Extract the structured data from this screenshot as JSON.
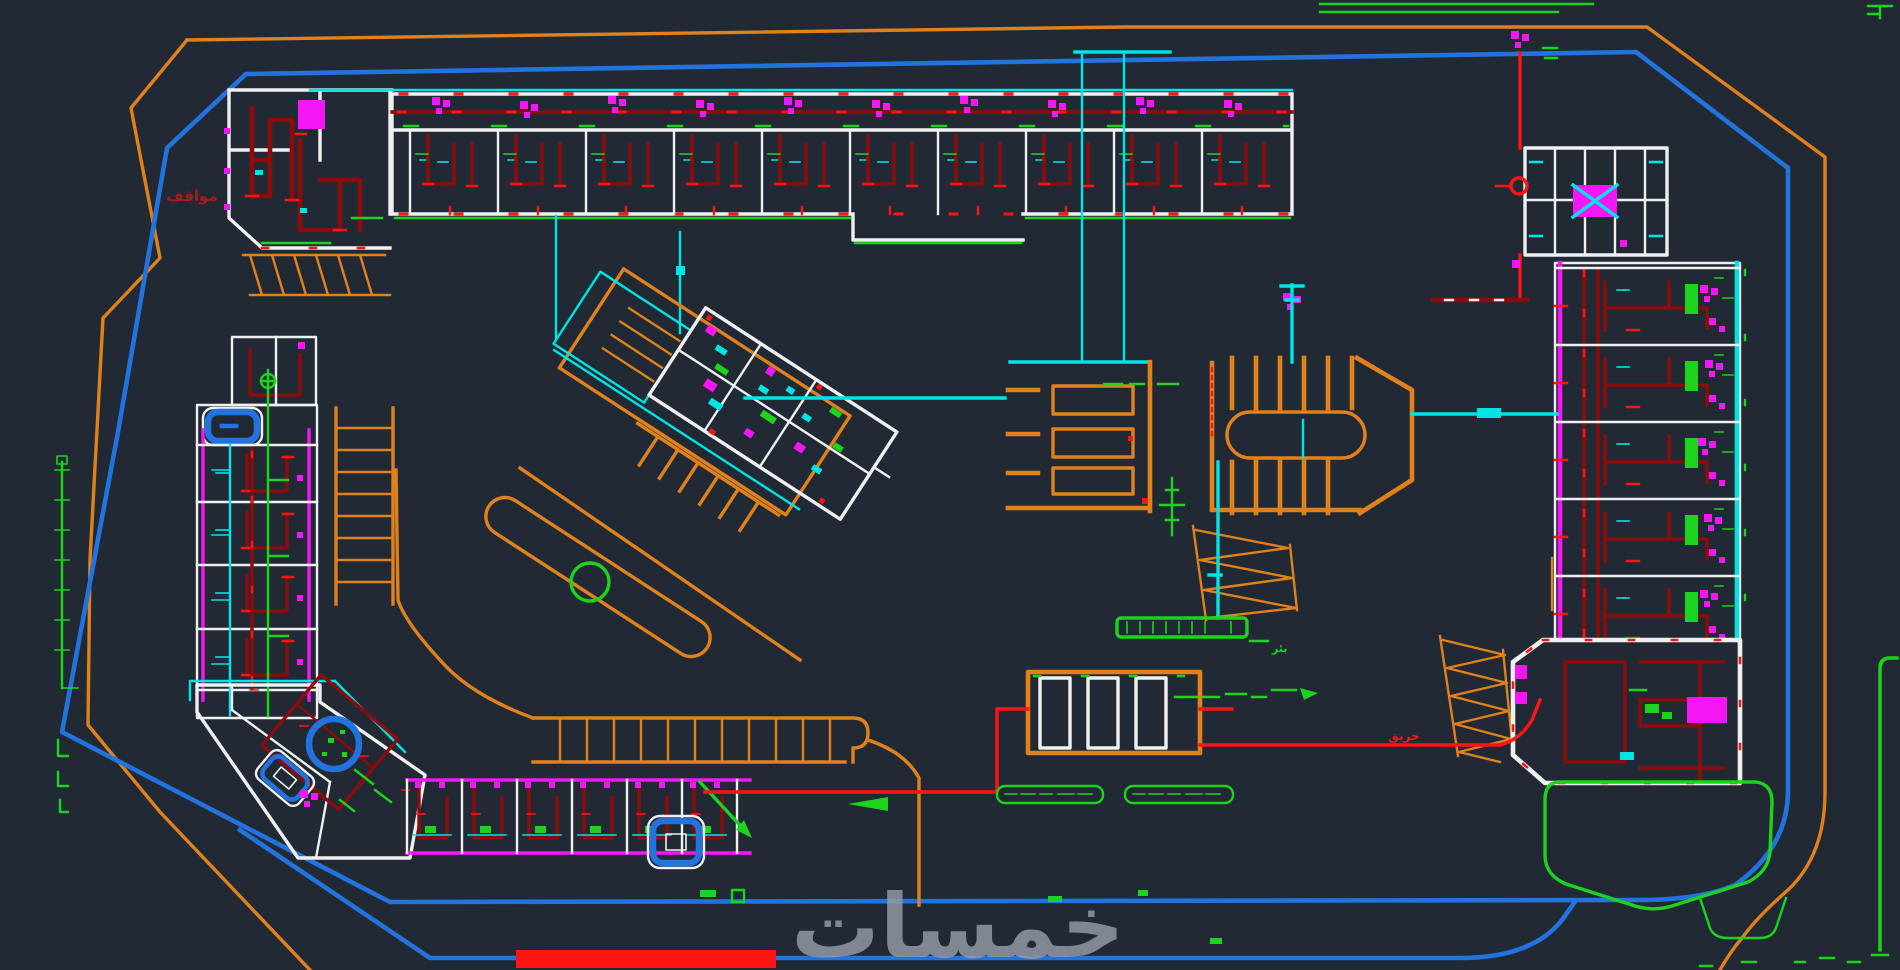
{
  "document": {
    "type": "cad-site-plan",
    "description": "AutoCAD-style resort site utilities plan rendered on dark model space; orange site boundary, blue internal road loop, buildings with white walls, dark-red fire piping, cyan water piping, magenta sanitary fixtures and green landscape elements"
  },
  "palette": {
    "bg": "#212934",
    "orange": "#E0811C",
    "blue": "#2273DD",
    "cyan": "#00E4E4",
    "red": "#FF1414",
    "darkred": "#8E0B0B",
    "magenta": "#F318F3",
    "green": "#1BD41B",
    "white": "#F0F0F0",
    "gray": "#939CA7",
    "labelred": "#A61C1C"
  },
  "texts": {
    "watermark": "خمسات",
    "label_parking": "مواقف",
    "label_fire": "حريق",
    "label_well": "بئر"
  },
  "features": {
    "site_boundary": "orange perimeter polyline",
    "road_loop": "blue internal road loop with double bottom lanes",
    "buildings": [
      "top-left-block",
      "top-strip-building",
      "top-right-annex",
      "right-wing-building",
      "bottom-right-building",
      "left-wing-building",
      "corner-building",
      "bottom-row-building",
      "diagonal-building",
      "pump-room"
    ],
    "site_elements": [
      "west-parking-comb",
      "east-parking-comb-with-oval",
      "center-parking-bar",
      "road-island-with-green-circle",
      "green-pond",
      "stair-hatches",
      "water-well-bar",
      "fire-main-line",
      "pool-icon",
      "spa-icon"
    ]
  }
}
